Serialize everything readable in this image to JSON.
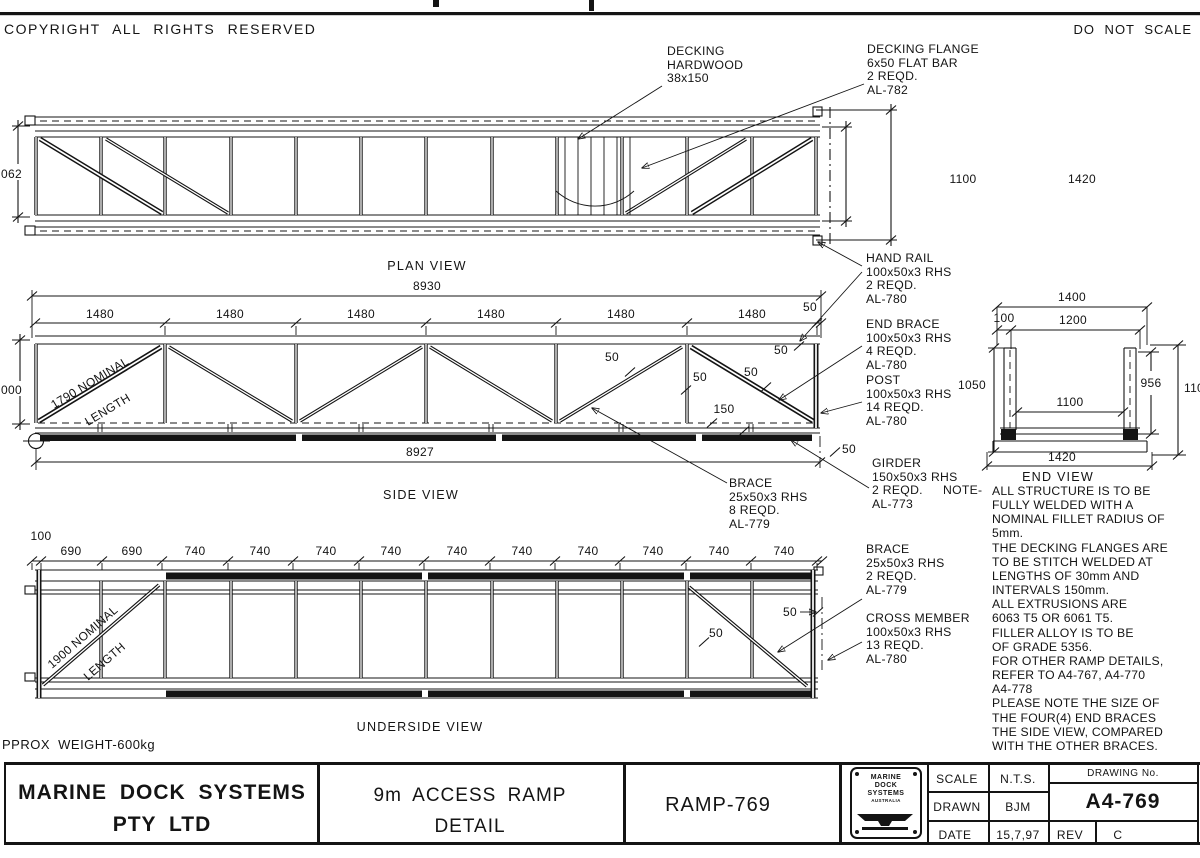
{
  "sheet": {
    "copyright": "COPYRIGHT ALL RIGHTS RESERVED",
    "do_not_scale": "DO NOT SCALE"
  },
  "plan_view": {
    "title": "PLAN VIEW",
    "decking_label": [
      "DECKING",
      "HARDWOOD",
      "38x150"
    ],
    "decking_flange_label": [
      "DECKING FLANGE",
      "6x50 FLAT BAR",
      "2 REQD.",
      "AL-782"
    ],
    "dims": {
      "frame_height": "062",
      "inner_height": "1100",
      "overall_height": "1420"
    }
  },
  "side_view": {
    "title": "SIDE VIEW",
    "dims": {
      "overall_top": "8930",
      "overall_bottom": "8927",
      "panels": [
        "1480",
        "1480",
        "1480",
        "1480",
        "1480",
        "1480"
      ],
      "end_offset": "50",
      "height_left": "000",
      "offset_a": "50",
      "offset_b": "50",
      "offset_c": "50",
      "offset_d": "50",
      "offset_e": "50",
      "girder_dim": "150",
      "nominal_line1": "1790  NOMINAL",
      "nominal_line2": "LENGTH"
    },
    "brace_label": [
      "BRACE",
      "25x50x3 RHS",
      "8 REQD.",
      "AL-779"
    ]
  },
  "end_view": {
    "title": "END VIEW",
    "dims": {
      "overall": "1400",
      "offset": "100",
      "inner_top": "1200",
      "height": "1050",
      "inner": "1100",
      "post": "956",
      "right": "110",
      "base": "1420"
    }
  },
  "underside_view": {
    "title": "UNDERSIDE VIEW",
    "weight": "PPROX WEIGHT-600kg",
    "dims": {
      "start": "100",
      "panels_690": [
        "690",
        "690"
      ],
      "panels_740": [
        "740",
        "740",
        "740",
        "740",
        "740",
        "740",
        "740",
        "740",
        "740",
        "740"
      ],
      "offset_a": "50",
      "offset_b": "50",
      "nominal_line1": "1900  NOMINAL",
      "nominal_line2": "LENGTH"
    }
  },
  "part_labels": {
    "hand_rail": [
      "HAND RAIL",
      "100x50x3 RHS",
      "2 REQD.",
      "AL-780"
    ],
    "end_brace": [
      "END BRACE",
      "100x50x3 RHS",
      "4 REQD.",
      "AL-780"
    ],
    "post": [
      "POST",
      "100x50x3 RHS",
      "14 REQD.",
      "AL-780"
    ],
    "girder": [
      "GIRDER",
      "150x50x3 RHS",
      "2 REQD.",
      "AL-773"
    ],
    "brace": [
      "BRACE",
      "25x50x3 RHS",
      "2 REQD.",
      "AL-779"
    ],
    "cross_member": [
      "CROSS MEMBER",
      "100x50x3 RHS",
      "13 REQD.",
      "AL-780"
    ]
  },
  "notes": {
    "heading": "NOTE-",
    "lines": [
      "ALL STRUCTURE IS TO BE",
      "FULLY WELDED WITH A",
      "NOMINAL FILLET RADIUS OF",
      "5mm.",
      "THE DECKING FLANGES ARE",
      "TO BE STITCH WELDED AT",
      "LENGTHS OF 30mm AND",
      "INTERVALS 150mm.",
      "ALL EXTRUSIONS ARE",
      "6063 T5 OR 6061 T5.",
      "FILLER ALLOY IS TO BE",
      "OF GRADE 5356.",
      "FOR OTHER RAMP DETAILS,",
      "REFER TO A4-767, A4-770",
      "A4-778",
      "PLEASE NOTE THE SIZE OF",
      "THE FOUR(4) END BRACES",
      "THE SIDE VIEW, COMPARED",
      "WITH THE OTHER BRACES."
    ]
  },
  "title_block": {
    "company_line1": "MARINE DOCK SYSTEMS",
    "company_line2": "PTY LTD",
    "title_line1": "9m ACCESS RAMP",
    "title_line2": "DETAIL",
    "ramp_no": "RAMP-769",
    "logo_lines": [
      "MARINE",
      "DOCK",
      "SYSTEMS",
      "AUSTRALIA"
    ],
    "scale_label": "SCALE",
    "scale_value": "N.T.S.",
    "drawn_label": "DRAWN",
    "drawn_value": "BJM",
    "date_label": "DATE",
    "date_value": "15,7,97",
    "drawing_no_label": "DRAWING No.",
    "drawing_no": "A4-769",
    "rev_label": "REV",
    "rev_value": "C"
  },
  "colors": {
    "ink": "#141414",
    "paper": "#ffffff"
  }
}
